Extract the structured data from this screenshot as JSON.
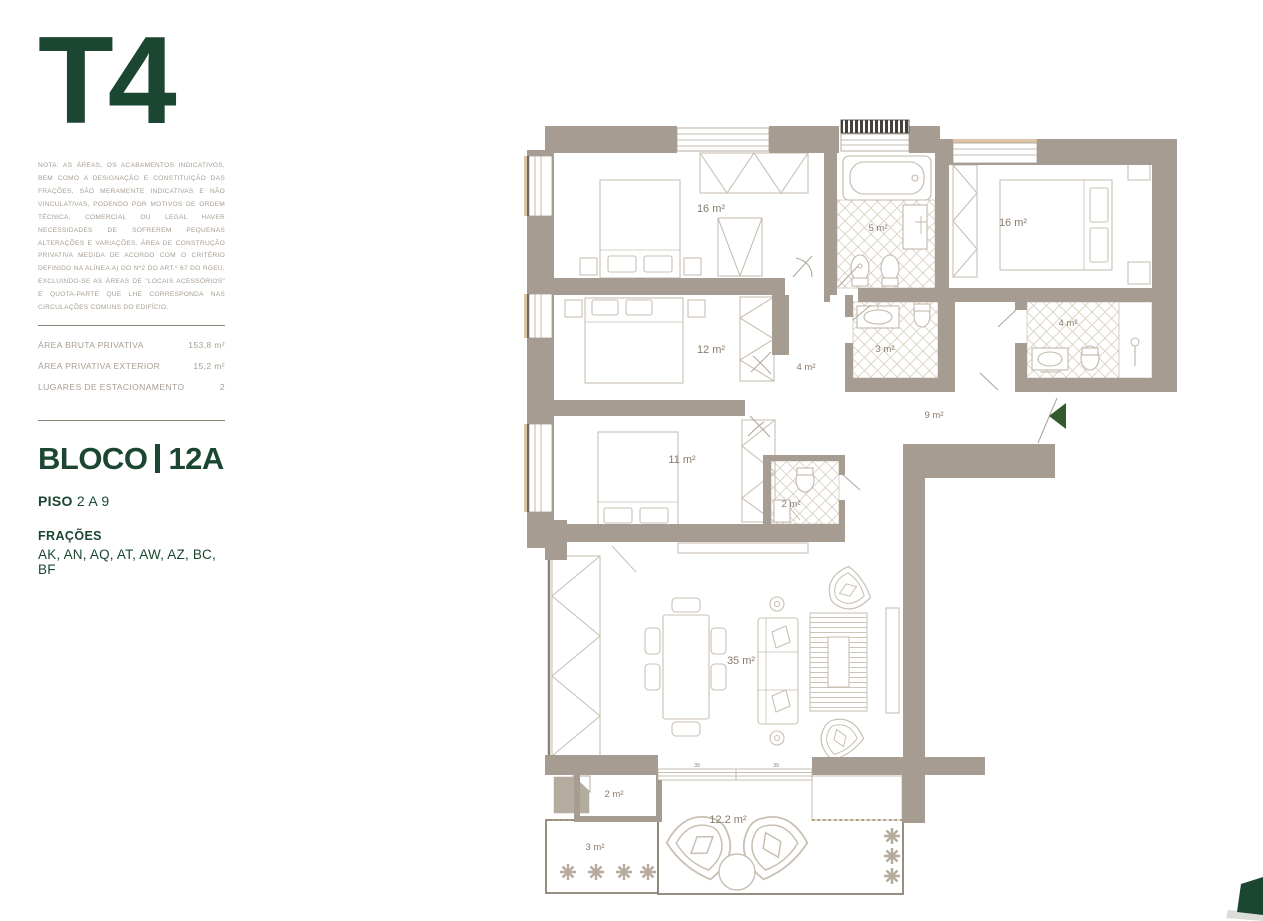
{
  "sidebar": {
    "title": "T4",
    "note": "NOTA: AS ÁREAS, OS ACABAMENTOS INDICATIVOS, BEM COMO A DESIGNAÇÃO E CONSTITUIÇÃO DAS FRAÇÕES, SÃO MERAMENTE INDICATIVAS E NÃO VINCULATIVAS, PODENDO POR MOTIVOS DE ORDEM TÉCNICA, COMERCIAL OU LEGAL HAVER NECESSIDADES DE SOFREREM PEQUENAS ALTERAÇÕES E VARIAÇÕES. ÁREA DE CONSTRUÇÃO PRIVATIVA MEDIDA DE ACORDO COM O CRITÉRIO DEFINIDO NA ALÍNEA A) DO Nº2 DO ART.º 67 DO RGEU, EXCLUINDO-SE AS ÁREAS DE \"LOCAIS ACESSÓRIOS\" E QUOTA-PARTE QUE LHE CORRESPONDA NAS CIRCULAÇÕES COMUNS DO EDIFÍCIO.",
    "metrics": [
      {
        "label": "ÁREA BRUTA PRIVATIVA",
        "value": "153,8 m²"
      },
      {
        "label": "ÁREA PRIVATIVA EXTERIOR",
        "value": "15,2 m²"
      },
      {
        "label": "LUGARES DE ESTACIONAMENTO",
        "value": "2"
      }
    ],
    "bloco_label": "BLOCO",
    "bloco_value": "12A",
    "piso_label": "PISO",
    "piso_value": "2 A 9",
    "fracoes_label": "FRAÇÕES",
    "fracoes_value": "AK, AN, AQ, AT, AW, AZ, BC, BF"
  },
  "floor_plan": {
    "rooms": [
      {
        "name": "bedroom-top-left",
        "label": "16 m²"
      },
      {
        "name": "bathroom-top",
        "label": "5 m²"
      },
      {
        "name": "bedroom-top-right",
        "label": "16 m²"
      },
      {
        "name": "bathroom-right",
        "label": "4 m²"
      },
      {
        "name": "bedroom-middle",
        "label": "12 m²"
      },
      {
        "name": "hall",
        "label": "4 m²"
      },
      {
        "name": "bathroom-middle",
        "label": "3 m²"
      },
      {
        "name": "corridor",
        "label": "9 m²"
      },
      {
        "name": "bedroom-lower",
        "label": "11 m²"
      },
      {
        "name": "bathroom-small",
        "label": "2 m²"
      },
      {
        "name": "living-room",
        "label": "35 m²"
      },
      {
        "name": "laundry",
        "label": "2 m²"
      },
      {
        "name": "balcony",
        "label": "3 m²"
      },
      {
        "name": "terrace",
        "label": "12.2 m²"
      }
    ],
    "door_marks": [
      "39",
      "39"
    ],
    "colors": {
      "wall": "#a69c91",
      "plan_label": "#897c6c",
      "accent_green": "#1b4732",
      "entrance_arrow": "#35592e"
    }
  }
}
